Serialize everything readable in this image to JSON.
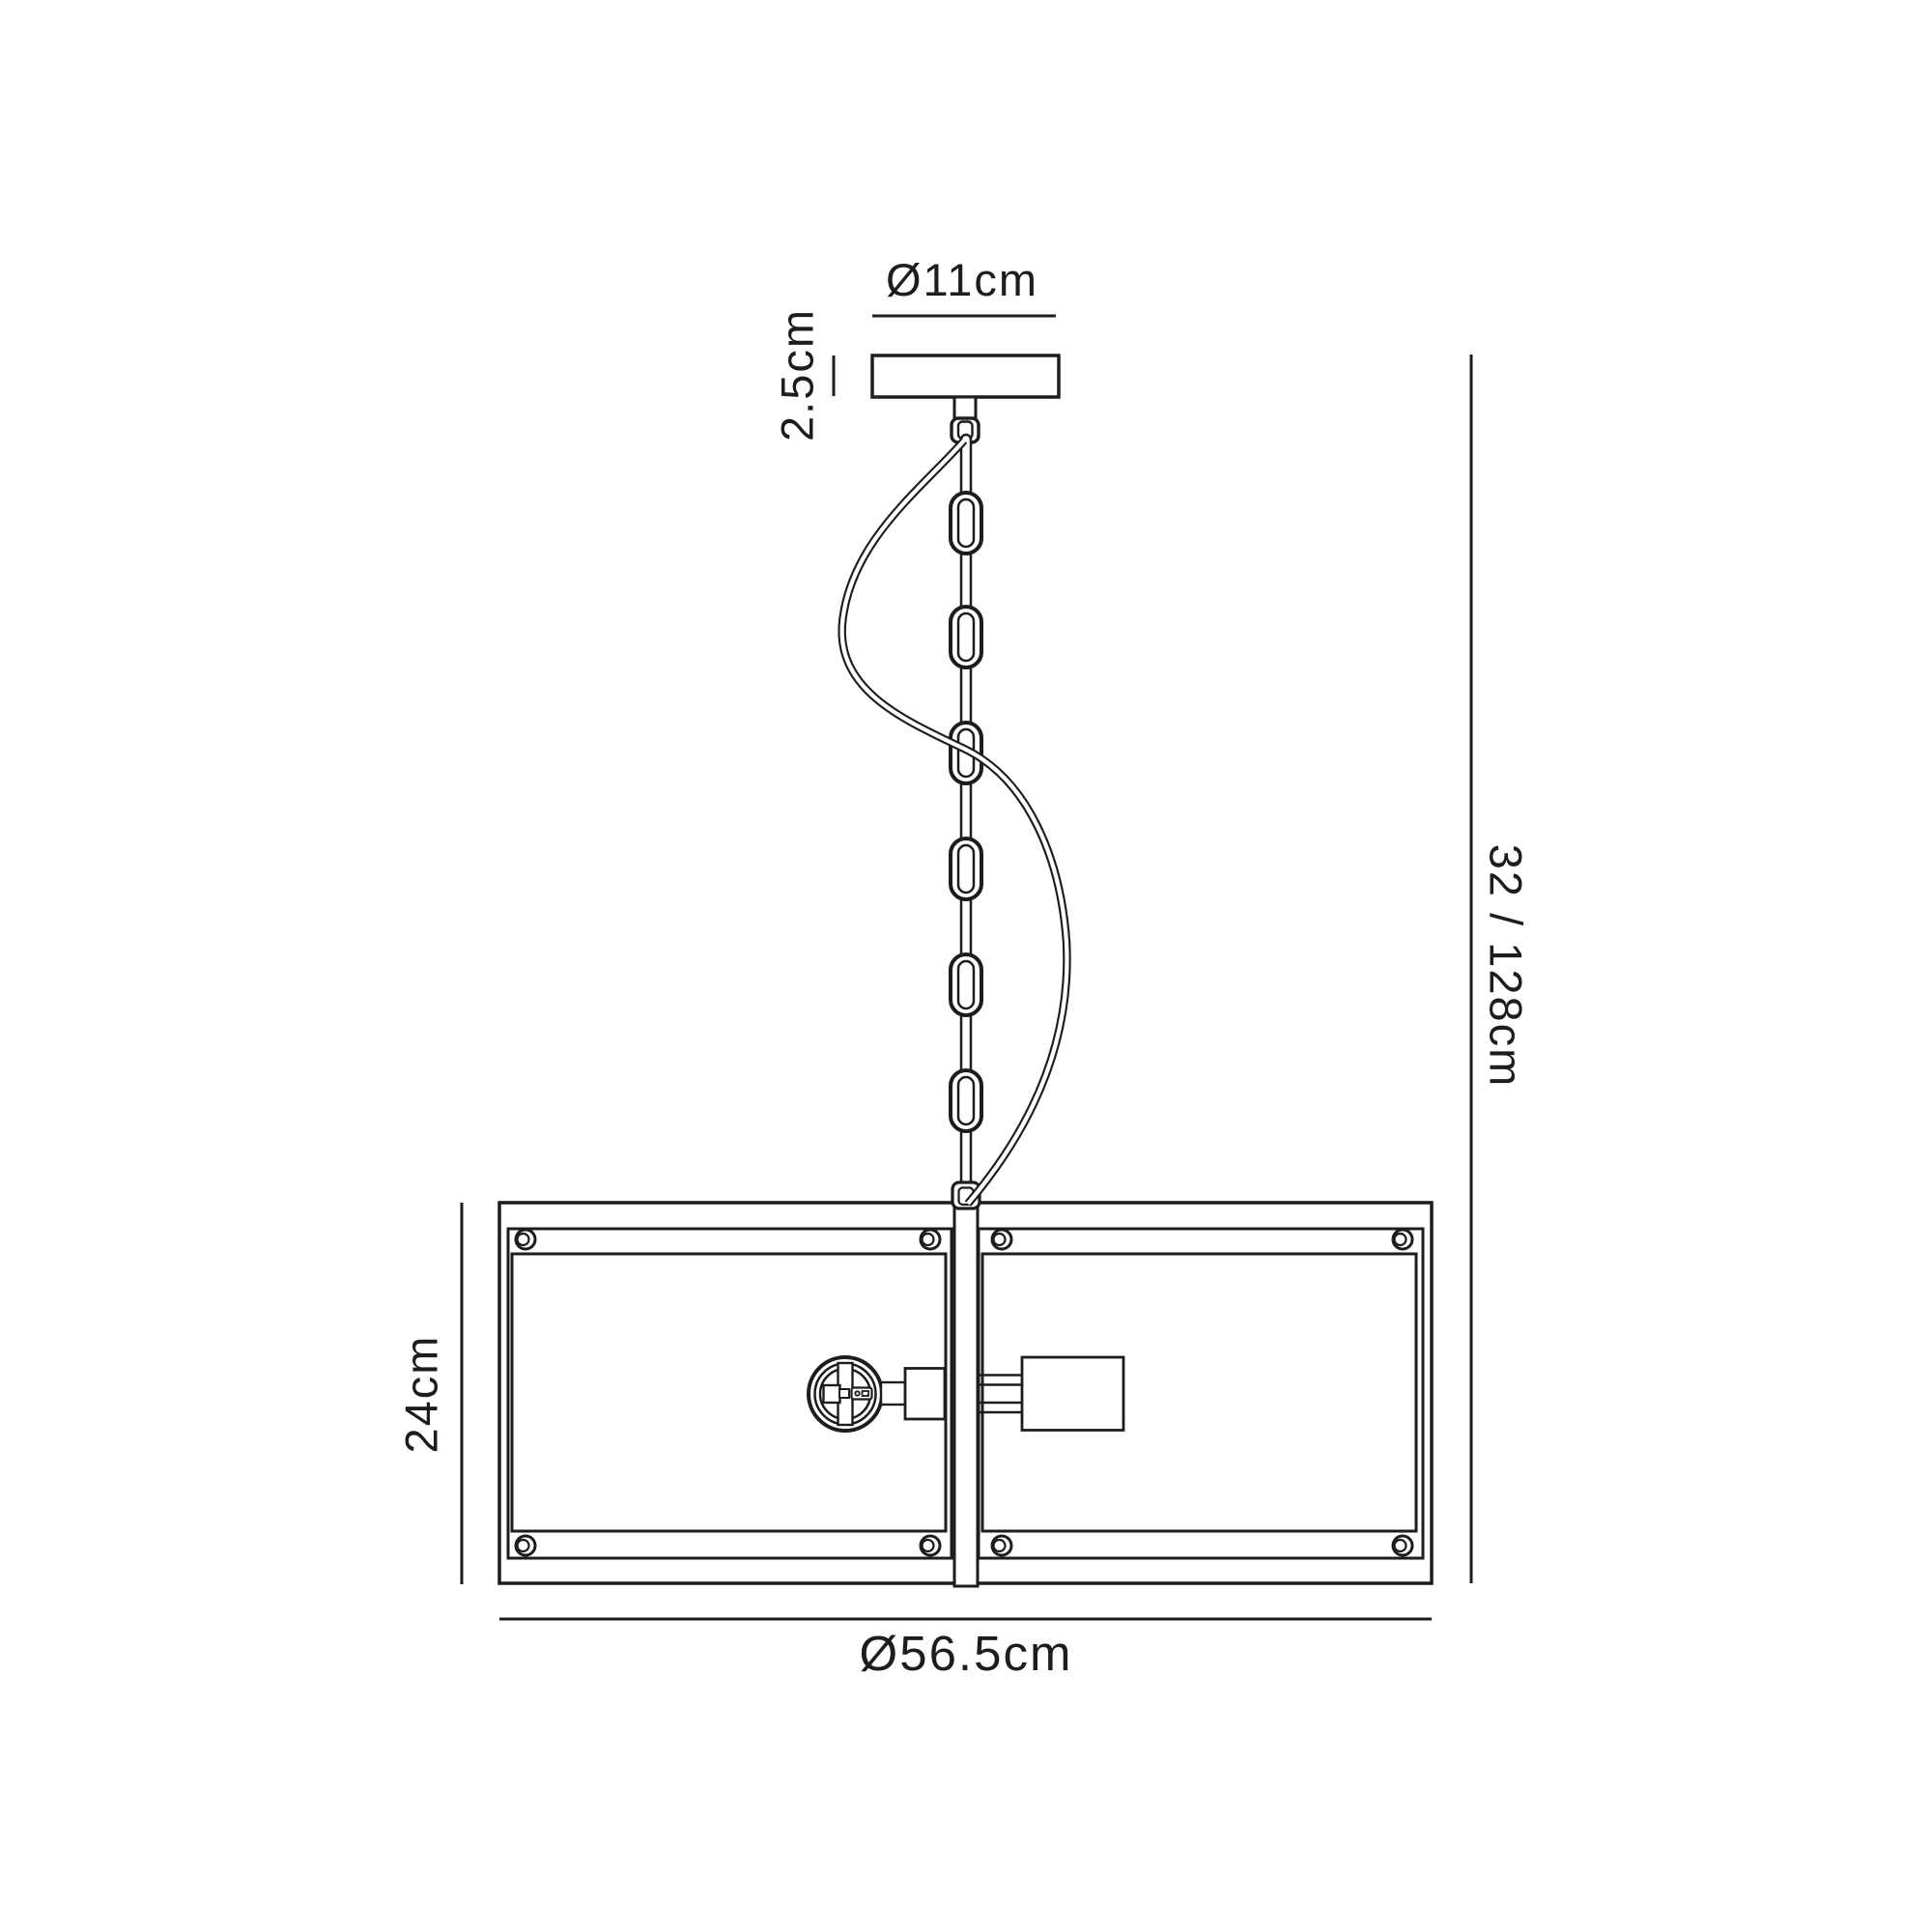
{
  "diagram": {
    "kind": "pendant-light-dimension-drawing",
    "labels": {
      "canopy_diameter": "Ø11cm",
      "canopy_height": "2.5cm",
      "overall_drop": "32 / 128cm",
      "shade_height": "24cm",
      "shade_diameter": "Ø56.5cm"
    },
    "colors": {
      "line": "#1d1d1b",
      "background": "#ffffff"
    }
  }
}
